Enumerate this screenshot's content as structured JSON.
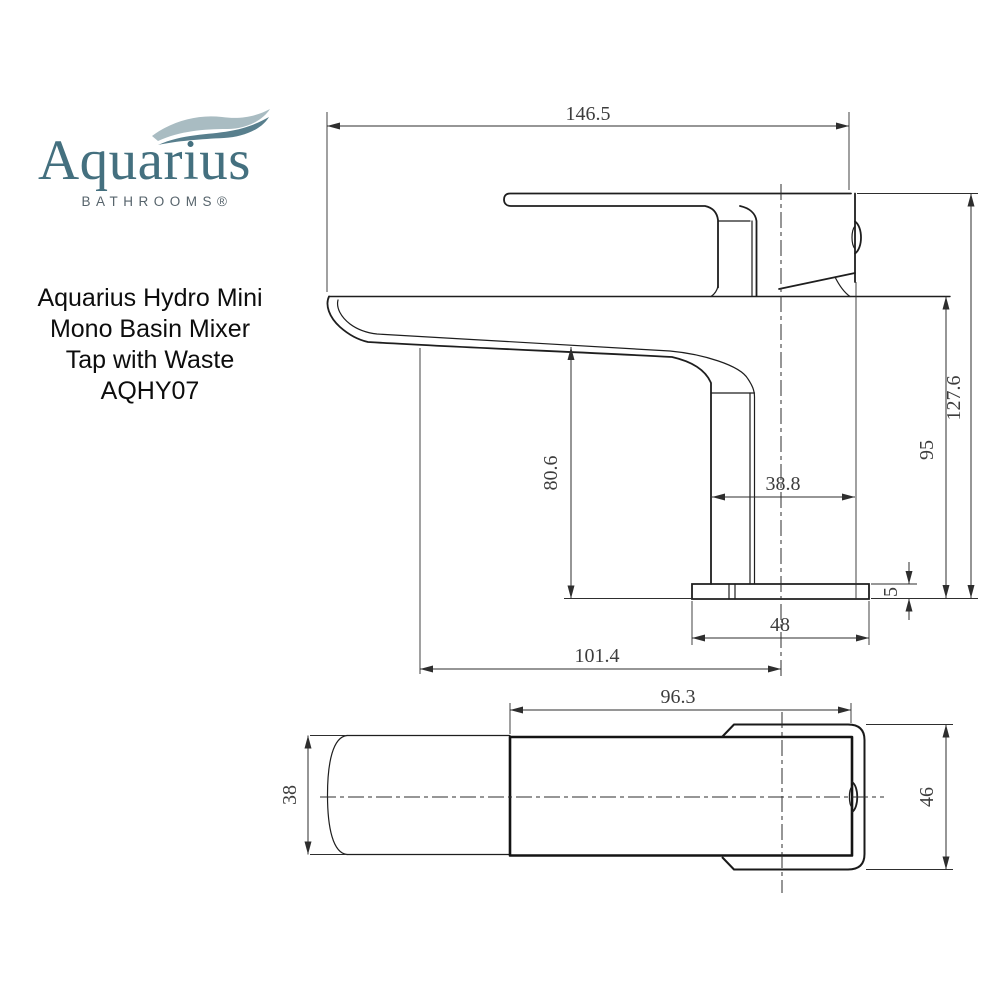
{
  "logo": {
    "brand": "Aquarius",
    "tagline": "BATHROOMS®",
    "brand_color": "#44707f",
    "wave_light_color": "#a9bcc2",
    "wave_dark_color": "#587f8d"
  },
  "product": {
    "lines": [
      "Aquarius Hydro Mini",
      "Mono Basin Mixer",
      "Tap with Waste",
      "AQHY07"
    ]
  },
  "side_view": {
    "overall_length": "146.5",
    "overall_height": "127.6",
    "height_to_spout": "95",
    "spout_clearance": "80.6",
    "spout_offset": "38.8",
    "base_thickness": "5",
    "base_width": "48",
    "spout_reach": "101.4"
  },
  "top_view": {
    "body_length": "96.3",
    "handle_width": "38",
    "flange_width": "46"
  },
  "colors": {
    "background": "#ffffff",
    "line": "#1e1e1e",
    "dimension_text": "#3d3d3d",
    "product_text": "#0d0d0d"
  }
}
